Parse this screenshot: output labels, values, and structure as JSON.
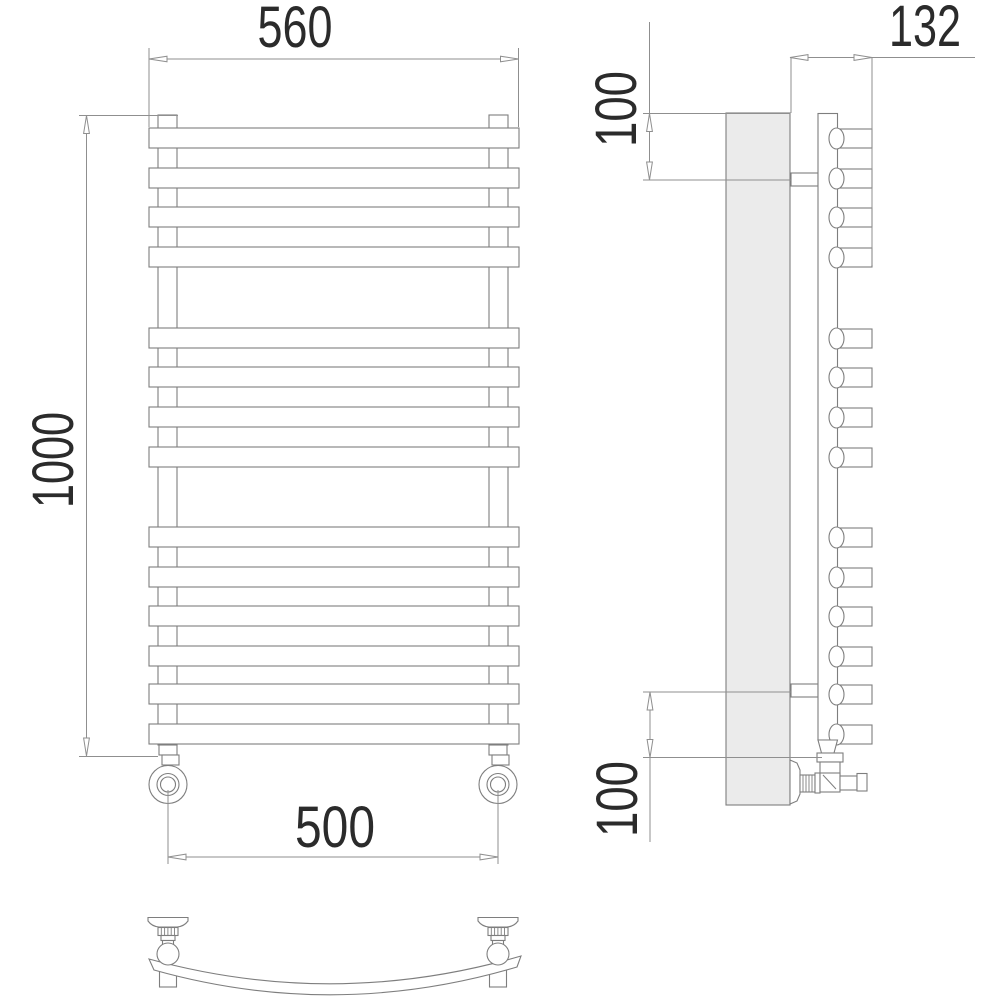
{
  "drawing": {
    "title": "towel-rail-radiator-technical-drawing",
    "colors": {
      "background": "#ffffff",
      "object_line": "#7e7e7e",
      "dimension_line": "#8f8f8f",
      "text": "#2b2b2b",
      "wall_fill": "#ebebeb"
    },
    "dimensions": {
      "overall_width_mm": "560",
      "overall_height_mm": "1000",
      "connection_spacing_mm": "500",
      "depth_mm": "132",
      "top_bracket_offset_mm": "100",
      "bottom_bracket_offset_mm": "100"
    },
    "front_view": {
      "bar_count": 14,
      "bar_rows_y": [
        128,
        168,
        207,
        247,
        328,
        367,
        407,
        447,
        527,
        567,
        606,
        646,
        684,
        724
      ],
      "bar_x": 149,
      "bar_width": 370,
      "bar_height": 20,
      "risers_x": [
        158,
        489
      ],
      "riser_width": 19,
      "riser_top": 115,
      "riser_bottom": 745,
      "valve_centers_x": [
        168,
        498
      ],
      "valve_center_y": 784.5,
      "valve_radii": [
        19,
        11,
        7.5
      ]
    },
    "side_view": {
      "tube_count": 14,
      "tube_rows_y": [
        128,
        168,
        207,
        247,
        328,
        367,
        407,
        447,
        527,
        567,
        606,
        646,
        684,
        724
      ],
      "tube_end_cx": 836.5,
      "tube_right": 872,
      "wall": {
        "x": 726,
        "y": 113,
        "width": 64,
        "height": 692
      },
      "collector": {
        "x": 818,
        "y": 113.5,
        "width": 19.5,
        "bottom": 740
      },
      "bracket_rows_y": [
        173,
        684
      ]
    },
    "bottom_view": {
      "valve_centers_x": [
        168,
        498
      ],
      "ball_cy": 954,
      "ball_r": 11
    }
  }
}
